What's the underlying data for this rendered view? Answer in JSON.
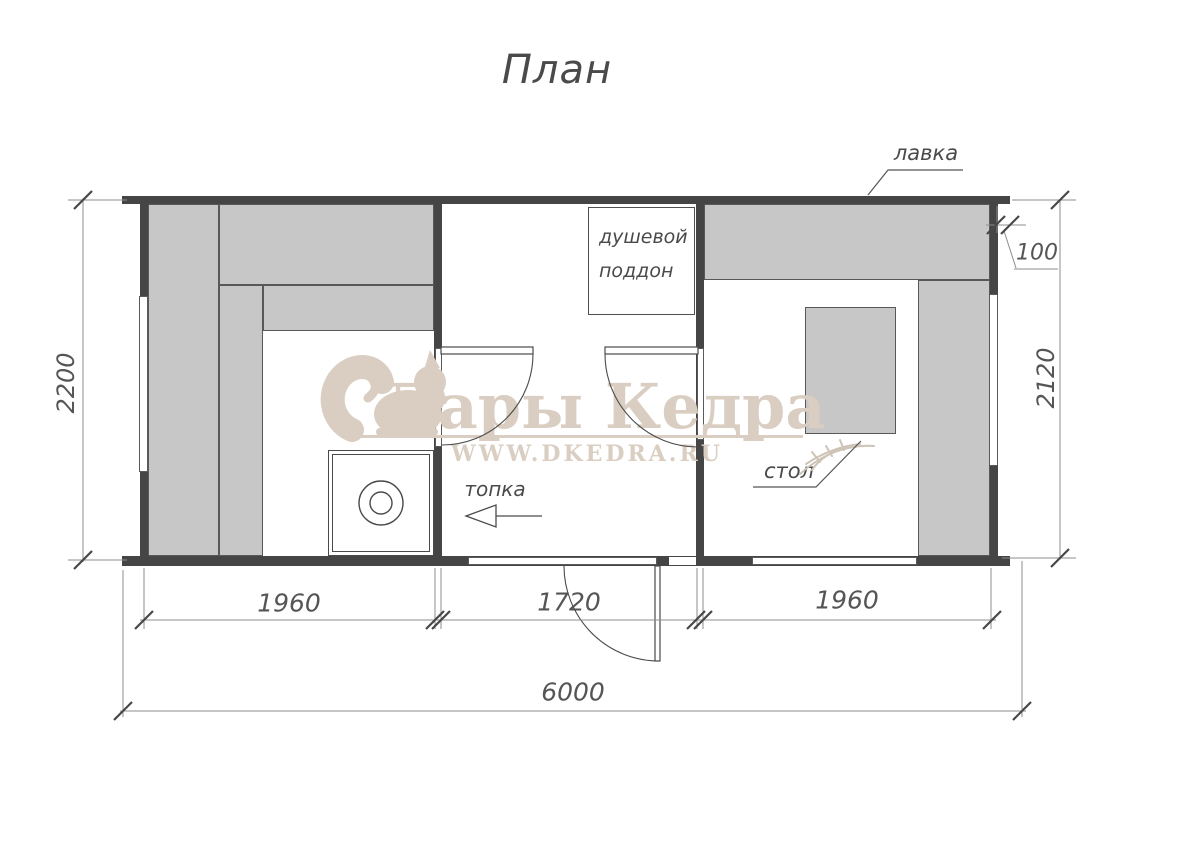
{
  "title": "План",
  "watermark": {
    "brand": "Дары Кедра",
    "url": "WWW.DKEDRA.RU"
  },
  "labels": {
    "bench": "лавка",
    "shower_line1": "душевой",
    "shower_line2": "поддон",
    "firebox": "топка",
    "table": "стол"
  },
  "dimensions": {
    "left_height": "2200",
    "right_height": "2120",
    "wall_thickness": "100",
    "left_room_width": "1960",
    "middle_room_width": "1720",
    "right_room_width": "1960",
    "total_width": "6000"
  },
  "colors": {
    "wall": "#454545",
    "furniture_fill": "#c7c7c7",
    "drawing_line": "#4a4a4a",
    "dim_line": "#8c8c8c",
    "watermark": "#d9cec1"
  }
}
